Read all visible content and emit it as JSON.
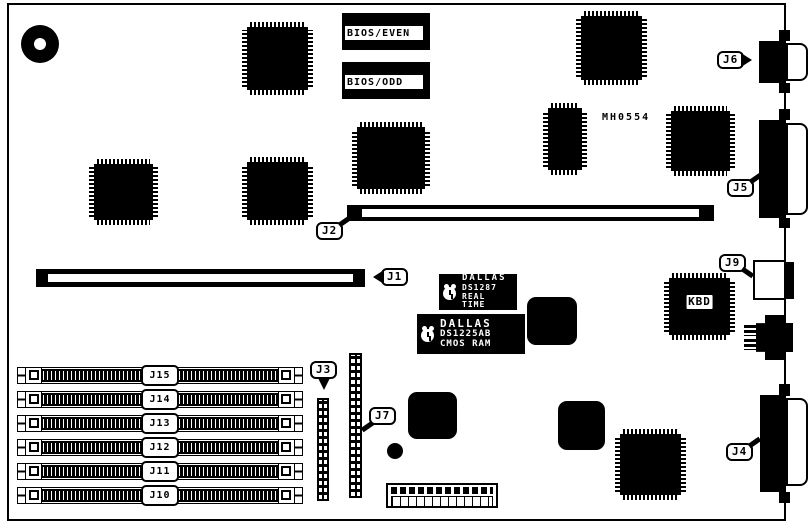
{
  "labels": {
    "bios_even": "BIOS/EVEN",
    "bios_odd": "BIOS/ODD",
    "part_number": "MH0554",
    "kbd": "KBD"
  },
  "rtc_chip": {
    "brand": "DALLAS",
    "part": "DS1287",
    "type": "REAL TIME"
  },
  "nvram_chip": {
    "brand": "DALLAS",
    "part": "DS1225AB",
    "type": "CMOS RAM"
  },
  "callouts": {
    "j1": "J1",
    "j2": "J2",
    "j3": "J3",
    "j4": "J4",
    "j5": "J5",
    "j6": "J6",
    "j7": "J7",
    "j9": "J9"
  },
  "simm_slots": [
    {
      "label": "J15"
    },
    {
      "label": "J14"
    },
    {
      "label": "J13"
    },
    {
      "label": "J12"
    },
    {
      "label": "J11"
    },
    {
      "label": "J10"
    }
  ]
}
